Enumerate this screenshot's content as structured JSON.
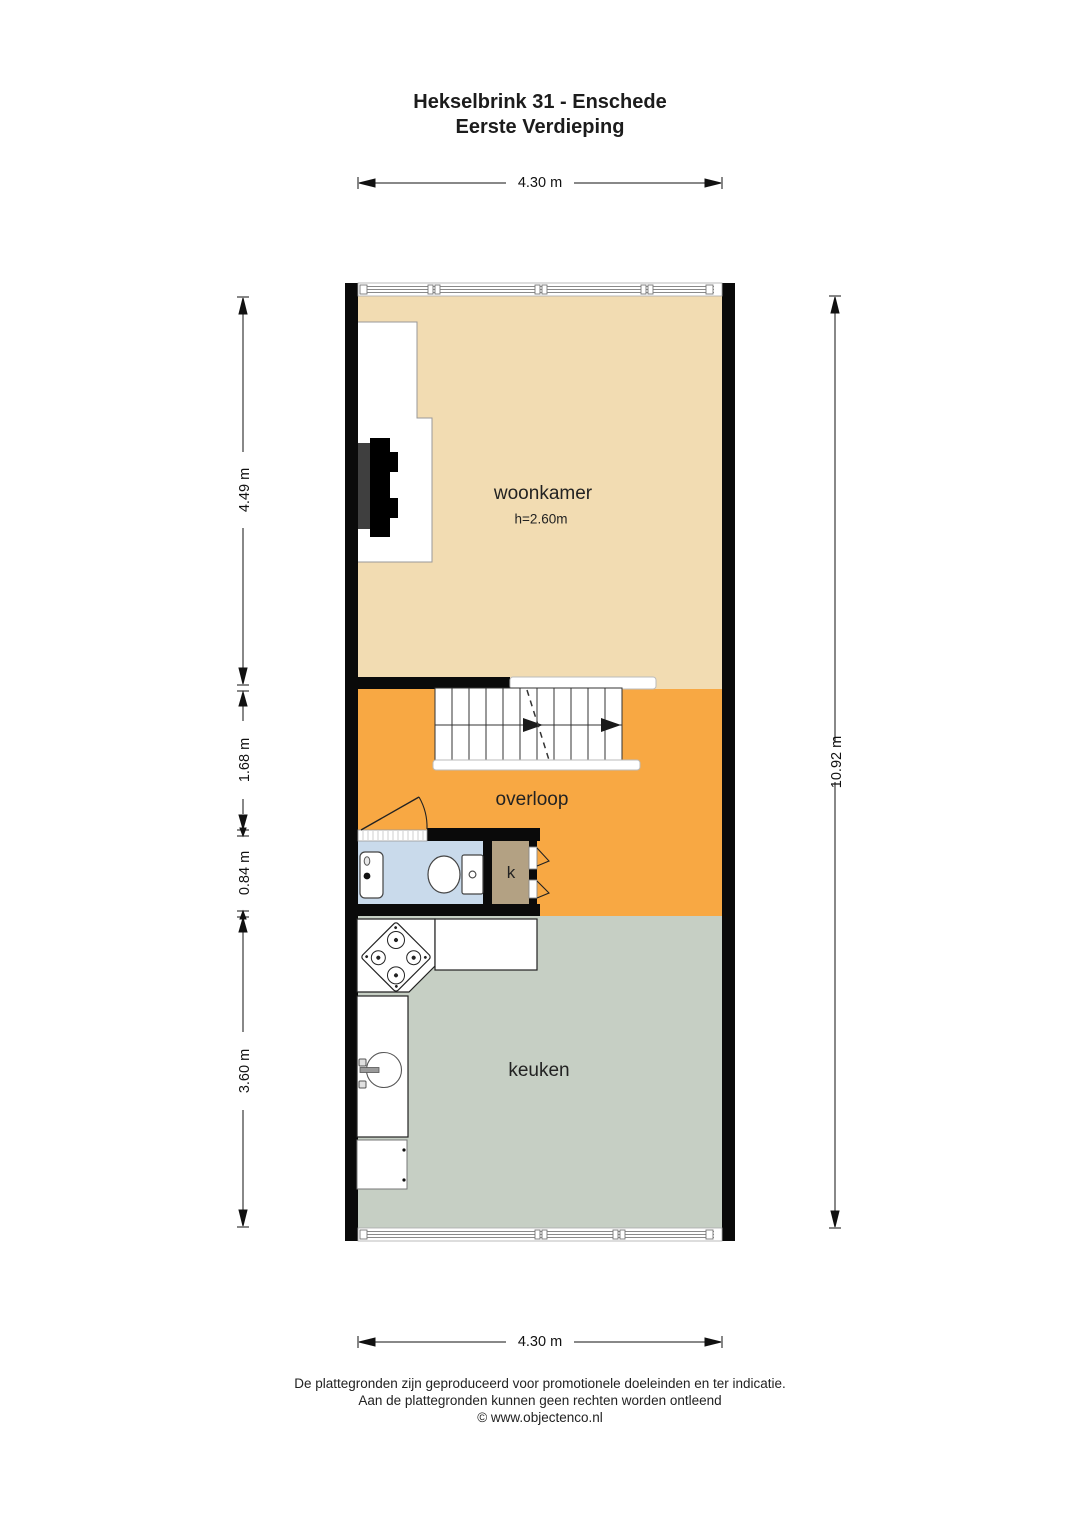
{
  "title": {
    "line1": "Hekselbrink 31 - Enschede",
    "line2": "Eerste Verdieping"
  },
  "dimensions": {
    "top": "4.30 m",
    "bottom": "4.30 m",
    "right": "10.92 m",
    "left": [
      {
        "label": "4.49 m"
      },
      {
        "label": "1.68 m"
      },
      {
        "label": "0.84 m"
      },
      {
        "label": "3.60 m"
      }
    ]
  },
  "rooms": {
    "woonkamer": {
      "label": "woonkamer",
      "ceiling": "h=2.60m",
      "color": "#f2dcb2"
    },
    "overloop": {
      "label": "overloop",
      "color": "#f8a843"
    },
    "kast": {
      "label": "k",
      "color": "#b3a183"
    },
    "keuken": {
      "label": "keuken",
      "color": "#c6cfc4"
    },
    "badkamer": {
      "color": "#c9daeb"
    }
  },
  "plan": {
    "wall_color": "#0a0a0a",
    "stair_arrow_color": "#1a1a1a"
  },
  "footer": {
    "line1": "De plattegronden zijn geproduceerd voor promotionele doeleinden en ter indicatie.",
    "line2": "Aan de plattegronden kunnen geen rechten worden ontleend",
    "line3": "© www.objectenco.nl"
  }
}
